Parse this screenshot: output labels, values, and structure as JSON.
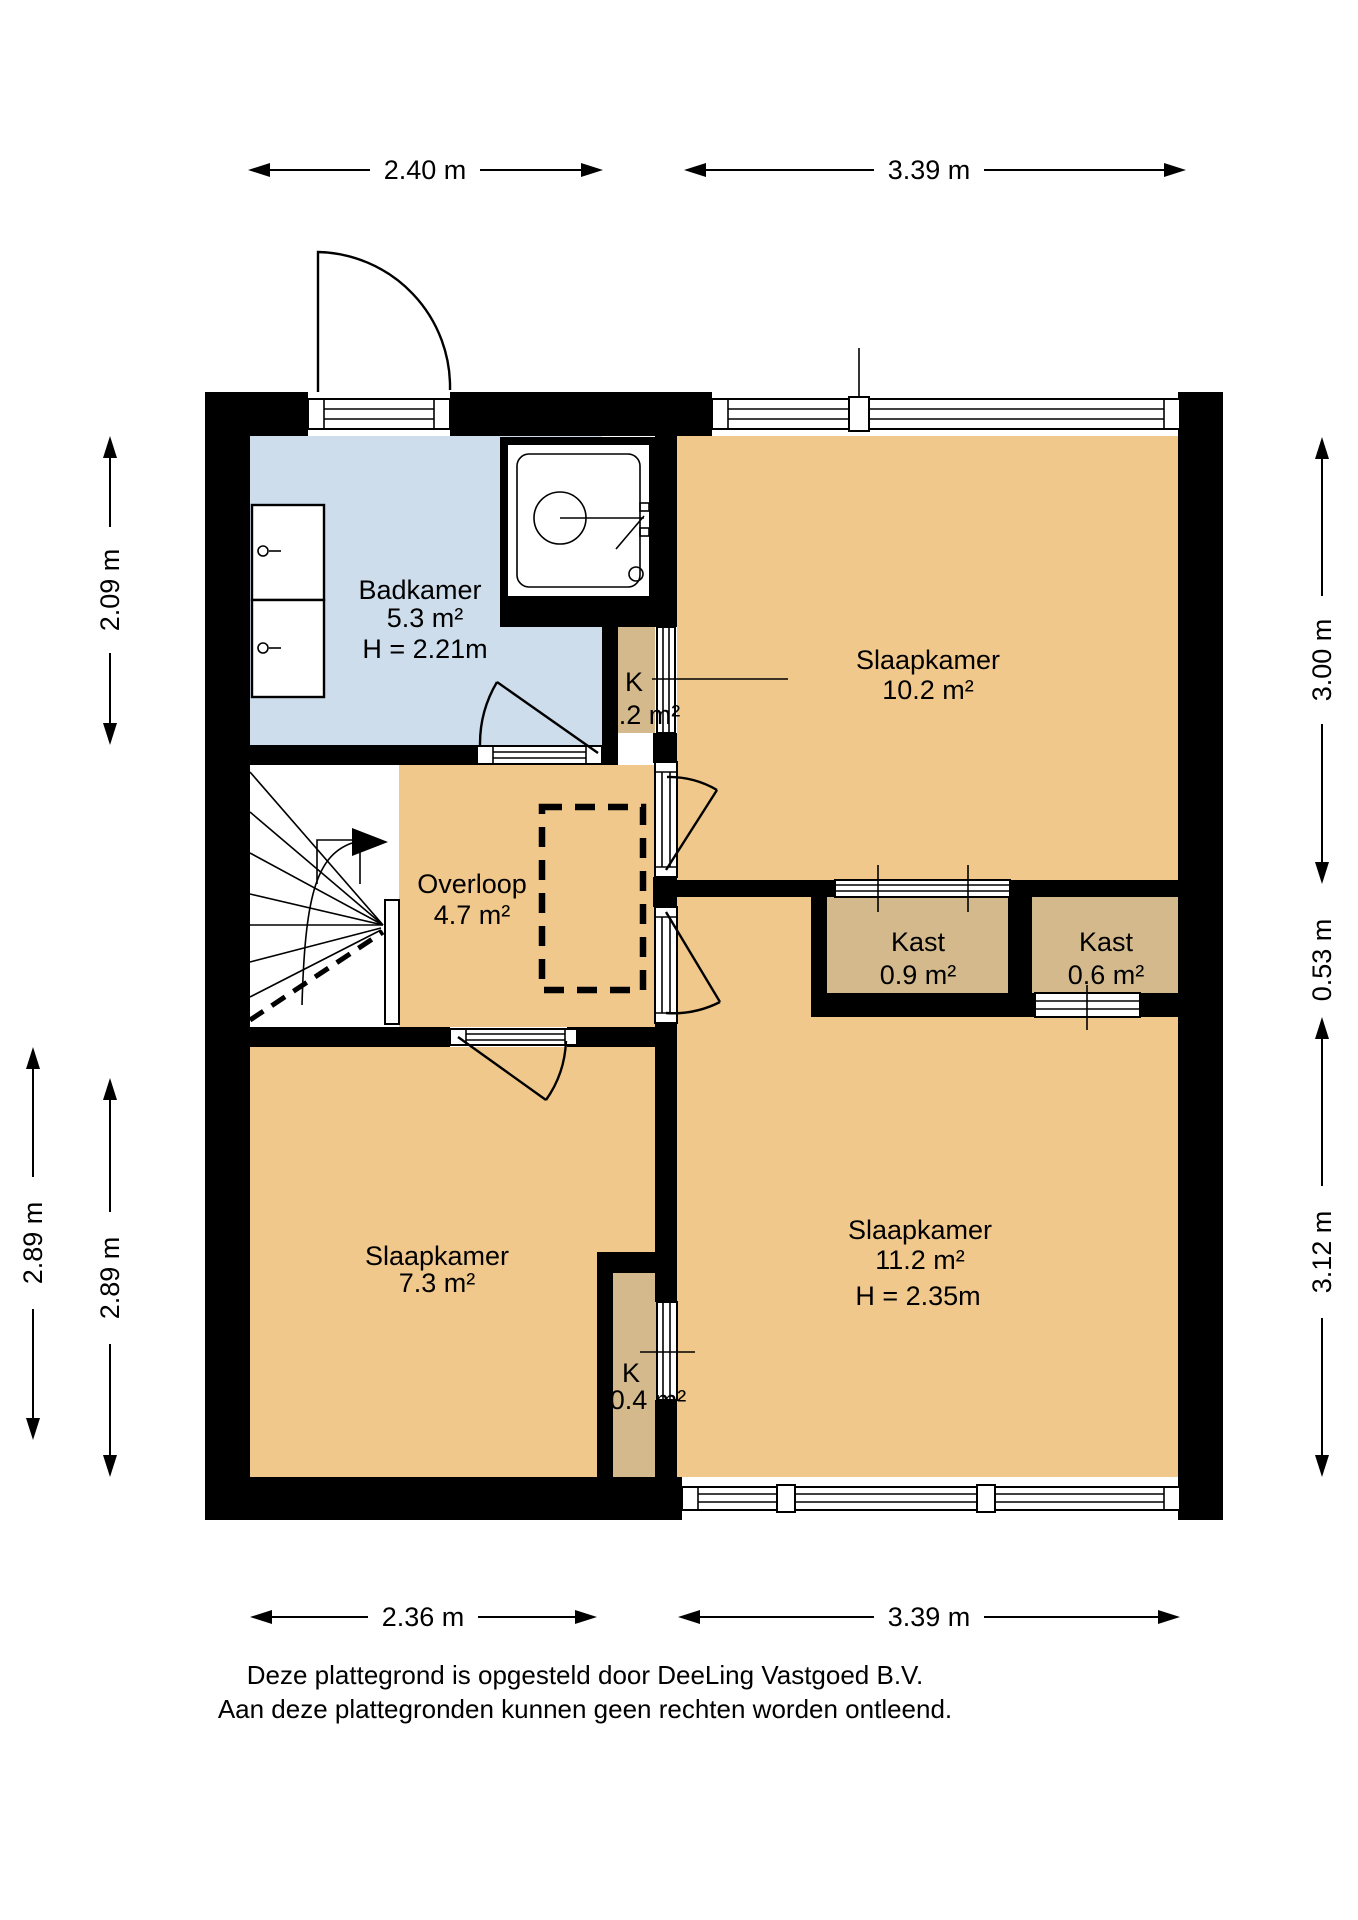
{
  "rooms": {
    "badkamer": {
      "name": "Badkamer",
      "area": "5.3 m²",
      "height": "H = 2.21m"
    },
    "slaapkamer1": {
      "name": "Slaapkamer",
      "area": "10.2 m²"
    },
    "slaapkamer2": {
      "name": "Slaapkamer",
      "area": "11.2 m²",
      "height": "H = 2.35m"
    },
    "slaapkamer3": {
      "name": "Slaapkamer",
      "area": "7.3 m²"
    },
    "overloop": {
      "name": "Overloop",
      "area": "4.7 m²"
    },
    "kast1": {
      "name": "Kast",
      "area": "0.9 m²"
    },
    "kast2": {
      "name": "Kast",
      "area": "0.6 m²"
    },
    "k1": {
      "name": "K",
      "area": "0.2 m²"
    },
    "k2": {
      "name": "K",
      "area": "0.4 m²"
    }
  },
  "dims": {
    "top_left": "2.40 m",
    "top_right": "3.39 m",
    "bottom_left": "2.36 m",
    "bottom_right": "3.39 m",
    "left_top": "2.09 m",
    "left_outer": "2.89 m",
    "left_inner": "2.89 m",
    "right_top": "3.00 m",
    "right_middle": "0.53 m",
    "right_bottom": "3.12 m"
  },
  "footer": {
    "line1": "Deze plattegrond is opgesteld door DeeLing Vastgoed B.V.",
    "line2": "Aan deze plattegronden kunnen geen rechten worden ontleend."
  },
  "colors": {
    "wall": "#000000",
    "room": "#F1C88B",
    "closet": "#D4B98C",
    "bathroom": "#CEDDEB",
    "white": "#FFFFFF"
  }
}
